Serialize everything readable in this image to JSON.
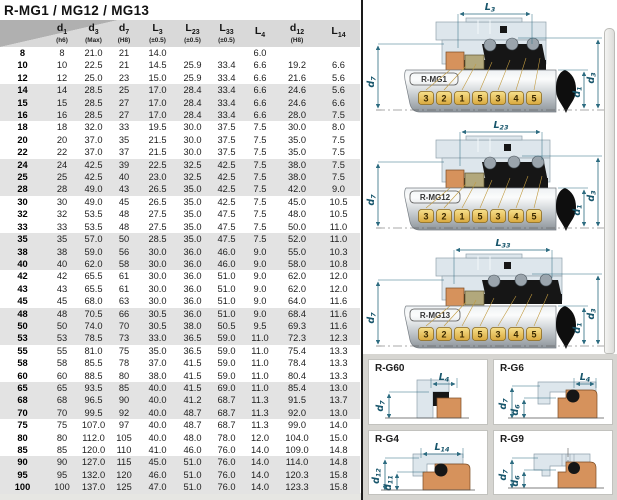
{
  "title": "R-MG1 / MG12 / MG13",
  "table": {
    "columns": [
      {
        "base": "",
        "sub": "",
        "note": ""
      },
      {
        "base": "d",
        "sub": "1",
        "note": "(h6)"
      },
      {
        "base": "d",
        "sub": "3",
        "note": "(Max)"
      },
      {
        "base": "d",
        "sub": "7",
        "note": "(H8)"
      },
      {
        "base": "L",
        "sub": "3",
        "note": "(±0.5)"
      },
      {
        "base": "L",
        "sub": "23",
        "note": "(±0.5)"
      },
      {
        "base": "L",
        "sub": "33",
        "note": "(±0.5)"
      },
      {
        "base": "L",
        "sub": "4",
        "note": ""
      },
      {
        "base": "d",
        "sub": "12",
        "note": "(H8)"
      },
      {
        "base": "L",
        "sub": "14",
        "note": ""
      }
    ],
    "rows": [
      [
        "8",
        "8",
        "21.0",
        "21",
        "14.0",
        "",
        "",
        "6.0",
        "",
        ""
      ],
      [
        "10",
        "10",
        "22.5",
        "21",
        "14.5",
        "25.9",
        "33.4",
        "6.6",
        "19.2",
        "6.6"
      ],
      [
        "12",
        "12",
        "25.0",
        "23",
        "15.0",
        "25.9",
        "33.4",
        "6.6",
        "21.6",
        "5.6"
      ],
      [
        "14",
        "14",
        "28.5",
        "25",
        "17.0",
        "28.4",
        "33.4",
        "6.6",
        "24.6",
        "5.6"
      ],
      [
        "15",
        "15",
        "28.5",
        "27",
        "17.0",
        "28.4",
        "33.4",
        "6.6",
        "24.6",
        "6.6"
      ],
      [
        "16",
        "16",
        "28.5",
        "27",
        "17.0",
        "28.4",
        "33.4",
        "6.6",
        "28.0",
        "7.5"
      ],
      [
        "18",
        "18",
        "32.0",
        "33",
        "19.5",
        "30.0",
        "37.5",
        "7.5",
        "30.0",
        "8.0"
      ],
      [
        "20",
        "20",
        "37.0",
        "35",
        "21.5",
        "30.0",
        "37.5",
        "7.5",
        "35.0",
        "7.5"
      ],
      [
        "22",
        "22",
        "37.0",
        "37",
        "21.5",
        "30.0",
        "37.5",
        "7.5",
        "35.0",
        "7.5"
      ],
      [
        "24",
        "24",
        "42.5",
        "39",
        "22.5",
        "32.5",
        "42.5",
        "7.5",
        "38.0",
        "7.5"
      ],
      [
        "25",
        "25",
        "42.5",
        "40",
        "23.0",
        "32.5",
        "42.5",
        "7.5",
        "38.0",
        "7.5"
      ],
      [
        "28",
        "28",
        "49.0",
        "43",
        "26.5",
        "35.0",
        "42.5",
        "7.5",
        "42.0",
        "9.0"
      ],
      [
        "30",
        "30",
        "49.0",
        "45",
        "26.5",
        "35.0",
        "42.5",
        "7.5",
        "45.0",
        "10.5"
      ],
      [
        "32",
        "32",
        "53.5",
        "48",
        "27.5",
        "35.0",
        "47.5",
        "7.5",
        "48.0",
        "10.5"
      ],
      [
        "33",
        "33",
        "53.5",
        "48",
        "27.5",
        "35.0",
        "47.5",
        "7.5",
        "50.0",
        "11.0"
      ],
      [
        "35",
        "35",
        "57.0",
        "50",
        "28.5",
        "35.0",
        "47.5",
        "7.5",
        "52.0",
        "11.0"
      ],
      [
        "38",
        "38",
        "59.0",
        "56",
        "30.0",
        "36.0",
        "46.0",
        "9.0",
        "55.0",
        "10.3"
      ],
      [
        "40",
        "40",
        "62.0",
        "58",
        "30.0",
        "36.0",
        "46.0",
        "9.0",
        "58.0",
        "10.8"
      ],
      [
        "42",
        "42",
        "65.5",
        "61",
        "30.0",
        "36.0",
        "51.0",
        "9.0",
        "62.0",
        "12.0"
      ],
      [
        "43",
        "43",
        "65.5",
        "61",
        "30.0",
        "36.0",
        "51.0",
        "9.0",
        "62.0",
        "12.0"
      ],
      [
        "45",
        "45",
        "68.0",
        "63",
        "30.0",
        "36.0",
        "51.0",
        "9.0",
        "64.0",
        "11.6"
      ],
      [
        "48",
        "48",
        "70.5",
        "66",
        "30.5",
        "36.0",
        "51.0",
        "9.0",
        "68.4",
        "11.6"
      ],
      [
        "50",
        "50",
        "74.0",
        "70",
        "30.5",
        "38.0",
        "50.5",
        "9.5",
        "69.3",
        "11.6"
      ],
      [
        "53",
        "53",
        "78.5",
        "73",
        "33.0",
        "36.5",
        "59.0",
        "11.0",
        "72.3",
        "12.3"
      ],
      [
        "55",
        "55",
        "81.0",
        "75",
        "35.0",
        "36.5",
        "59.0",
        "11.0",
        "75.4",
        "13.3"
      ],
      [
        "58",
        "58",
        "85.5",
        "78",
        "37.0",
        "41.5",
        "59.0",
        "11.0",
        "78.4",
        "13.3"
      ],
      [
        "60",
        "60",
        "88.5",
        "80",
        "38.0",
        "41.5",
        "59.0",
        "11.0",
        "80.4",
        "13.3"
      ],
      [
        "65",
        "65",
        "93.5",
        "85",
        "40.0",
        "41.5",
        "69.0",
        "11.0",
        "85.4",
        "13.0"
      ],
      [
        "68",
        "68",
        "96.5",
        "90",
        "40.0",
        "41.2",
        "68.7",
        "11.3",
        "91.5",
        "13.7"
      ],
      [
        "70",
        "70",
        "99.5",
        "92",
        "40.0",
        "48.7",
        "68.7",
        "11.3",
        "92.0",
        "13.0"
      ],
      [
        "75",
        "75",
        "107.0",
        "97",
        "40.0",
        "48.7",
        "68.7",
        "11.3",
        "99.0",
        "14.0"
      ],
      [
        "80",
        "80",
        "112.0",
        "105",
        "40.0",
        "48.0",
        "78.0",
        "12.0",
        "104.0",
        "15.0"
      ],
      [
        "85",
        "85",
        "120.0",
        "110",
        "41.0",
        "46.0",
        "76.0",
        "14.0",
        "109.0",
        "14.8"
      ],
      [
        "90",
        "90",
        "127.0",
        "115",
        "45.0",
        "51.0",
        "76.0",
        "14.0",
        "114.0",
        "14.8"
      ],
      [
        "95",
        "95",
        "132.0",
        "120",
        "46.0",
        "51.0",
        "76.0",
        "14.0",
        "120.3",
        "15.8"
      ],
      [
        "100",
        "100",
        "137.0",
        "125",
        "47.0",
        "51.0",
        "76.0",
        "14.0",
        "123.3",
        "15.8"
      ]
    ]
  },
  "seal_diagrams": [
    {
      "name": "R-MG1",
      "top_dim": {
        "base": "L",
        "sub": "3"
      },
      "left_dim": {
        "base": "d",
        "sub": "7"
      },
      "right_dims": [
        {
          "base": "d",
          "sub": "1"
        },
        {
          "base": "d",
          "sub": "3"
        }
      ],
      "callouts": [
        "3",
        "2",
        "1",
        "5",
        "3",
        "4",
        "5"
      ]
    },
    {
      "name": "R-MG12",
      "top_dim": {
        "base": "L",
        "sub": "23"
      },
      "left_dim": {
        "base": "d",
        "sub": "7"
      },
      "right_dims": [
        {
          "base": "d",
          "sub": "1"
        },
        {
          "base": "d",
          "sub": "3"
        }
      ],
      "callouts": [
        "3",
        "2",
        "1",
        "5",
        "3",
        "4",
        "5"
      ]
    },
    {
      "name": "R-MG13",
      "top_dim": {
        "base": "L",
        "sub": "33"
      },
      "left_dim": {
        "base": "d",
        "sub": "7"
      },
      "right_dims": [
        {
          "base": "d",
          "sub": "1"
        },
        {
          "base": "d",
          "sub": "3"
        }
      ],
      "callouts": [
        "3",
        "2",
        "1",
        "5",
        "3",
        "4",
        "5"
      ]
    }
  ],
  "detail_cards": [
    {
      "name": "R-G60",
      "top_dim": {
        "base": "L",
        "sub": "4"
      },
      "left_dims": [
        {
          "base": "d",
          "sub": "7"
        }
      ]
    },
    {
      "name": "R-G6",
      "top_dim": {
        "base": "L",
        "sub": "4"
      },
      "left_dims": [
        {
          "base": "d",
          "sub": "7"
        },
        {
          "base": "d",
          "sub": "6"
        }
      ]
    },
    {
      "name": "R-G4",
      "top_dim": {
        "base": "L",
        "sub": "14"
      },
      "left_dims": [
        {
          "base": "d",
          "sub": "12"
        },
        {
          "base": "d",
          "sub": "11"
        }
      ]
    },
    {
      "name": "R-G9",
      "top_dim": null,
      "left_dims": [
        {
          "base": "d",
          "sub": "7"
        },
        {
          "base": "d",
          "sub": "6"
        }
      ]
    }
  ],
  "colors": {
    "dimension_teal": "#2c6b80",
    "tag_gold": "#ecc763",
    "seat_orange": "#d6925c",
    "ring_olive": "#b2a87c",
    "housing_blue": "#dde6ec",
    "header_gray": "#d9d9d9",
    "row_stripe_gray": "#e3e3e3"
  }
}
